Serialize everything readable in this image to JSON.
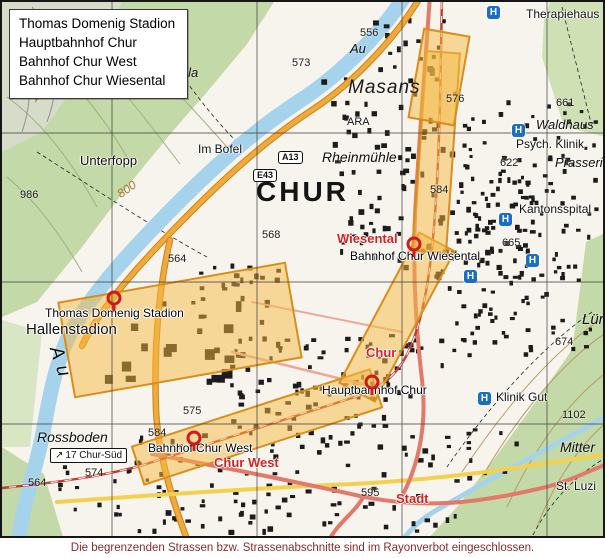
{
  "legend": {
    "items": [
      "Thomas Domenig Stadion",
      "Hauptbahnhof Chur",
      "Bahnhof Chur West",
      "Bahnhof Chur Wiesental"
    ]
  },
  "caption": "Die begrenzenden Strassen bzw. Strassenabschnitte sind im Rayonverbot eingeschlossen.",
  "colors": {
    "restriction_zone": "#f5b942",
    "station_pin": "#cf1b1b",
    "station_label_red": "#d92121",
    "caption_red": "#8a2b2b",
    "water_blue": "#a6d3ec",
    "hill_green": "#c4d9a8",
    "hospital_blue": "#1a6fc4"
  },
  "map": {
    "labels": [
      {
        "t": "CHUR",
        "x": 254,
        "y": 176,
        "c": "title"
      },
      {
        "t": "Masans",
        "x": 346,
        "y": 76,
        "c": "locality"
      },
      {
        "t": "Rheinmühle",
        "x": 320,
        "y": 148,
        "c": "place-italic",
        "fs": 14
      },
      {
        "t": "Therapiehaus",
        "x": 524,
        "y": 6,
        "c": "place"
      },
      {
        "t": "Waldhaus",
        "x": 534,
        "y": 116,
        "c": "place-italic"
      },
      {
        "t": "Psych. Klinik",
        "x": 514,
        "y": 136,
        "c": "place"
      },
      {
        "t": "Prasseri",
        "x": 553,
        "y": 154,
        "c": "place-italic"
      },
      {
        "t": "Kantonsspital",
        "x": 517,
        "y": 201,
        "c": "place"
      },
      {
        "t": "Klinik Gut",
        "x": 494,
        "y": 389,
        "c": "place"
      },
      {
        "t": "Unterfopp",
        "x": 78,
        "y": 152,
        "c": "place",
        "fs": 13
      },
      {
        "t": "Im Bofel",
        "x": 196,
        "y": 141,
        "c": "place"
      },
      {
        "t": "ARA",
        "x": 345,
        "y": 115,
        "c": "place",
        "fs": 11
      },
      {
        "t": "Au",
        "x": 348,
        "y": 40,
        "c": "place-italic"
      },
      {
        "t": "Au",
        "x": 62,
        "y": 342,
        "c": "place-italic",
        "fs": 19,
        "rot": 72,
        "ls": 7
      },
      {
        "t": "Rossboden",
        "x": 35,
        "y": 428,
        "c": "place-italic",
        "fs": 14
      },
      {
        "t": "ella",
        "x": 176,
        "y": 64,
        "c": "place-italic"
      },
      {
        "t": "Lürl",
        "x": 580,
        "y": 310,
        "c": "place-italic",
        "fs": 15
      },
      {
        "t": "Mitter",
        "x": 558,
        "y": 438,
        "c": "place-italic",
        "fs": 14
      },
      {
        "t": "St. Luzi",
        "x": 554,
        "y": 478,
        "c": "place"
      },
      {
        "t": "Hallenstadion",
        "x": 24,
        "y": 320,
        "c": "place",
        "fs": 15
      },
      {
        "t": "Thomas Domenig Stadion",
        "x": 43,
        "y": 305,
        "c": "station-black"
      },
      {
        "t": "Bahnhof Chur Wiesental",
        "x": 348,
        "y": 248,
        "c": "station-black"
      },
      {
        "t": "Hauptbahnhof Chur",
        "x": 320,
        "y": 382,
        "c": "station-black"
      },
      {
        "t": "Bahnhof Chur West",
        "x": 146,
        "y": 440,
        "c": "station-black"
      },
      {
        "t": "Wiesental",
        "x": 335,
        "y": 230,
        "c": "station-red"
      },
      {
        "t": "Chur",
        "x": 364,
        "y": 344,
        "c": "station-red"
      },
      {
        "t": "Chur West",
        "x": 212,
        "y": 454,
        "c": "station-red"
      },
      {
        "t": "Stadt",
        "x": 394,
        "y": 490,
        "c": "station-red"
      },
      {
        "t": "556",
        "x": 358,
        "y": 26,
        "c": "elev"
      },
      {
        "t": "573",
        "x": 290,
        "y": 56,
        "c": "elev"
      },
      {
        "t": "986",
        "x": 18,
        "y": 188,
        "c": "elev"
      },
      {
        "t": "568",
        "x": 260,
        "y": 228,
        "c": "elev"
      },
      {
        "t": "564",
        "x": 166,
        "y": 252,
        "c": "elev"
      },
      {
        "t": "576",
        "x": 444,
        "y": 92,
        "c": "elev"
      },
      {
        "t": "661",
        "x": 554,
        "y": 96,
        "c": "elev"
      },
      {
        "t": "622",
        "x": 498,
        "y": 156,
        "c": "elev"
      },
      {
        "t": "665",
        "x": 500,
        "y": 236,
        "c": "elev"
      },
      {
        "t": "674",
        "x": 553,
        "y": 335,
        "c": "elev"
      },
      {
        "t": "1102",
        "x": 560,
        "y": 408,
        "c": "elev"
      },
      {
        "t": "584",
        "x": 428,
        "y": 183,
        "c": "elev"
      },
      {
        "t": "584",
        "x": 146,
        "y": 426,
        "c": "elev"
      },
      {
        "t": "575",
        "x": 181,
        "y": 404,
        "c": "elev"
      },
      {
        "t": "574",
        "x": 83,
        "y": 466,
        "c": "elev"
      },
      {
        "t": "564",
        "x": 26,
        "y": 476,
        "c": "elev"
      },
      {
        "t": "595",
        "x": 359,
        "y": 486,
        "c": "elev"
      },
      {
        "t": "1200",
        "x": 25,
        "y": 95,
        "c": "contour-num",
        "rot": -55
      },
      {
        "t": "800",
        "x": 113,
        "y": 188,
        "c": "contour-num",
        "rot": -35
      }
    ],
    "pins": [
      {
        "name": "thomas-domenig-stadion",
        "x": 112,
        "y": 296
      },
      {
        "name": "bahnhof-chur-wiesental",
        "x": 412,
        "y": 242
      },
      {
        "name": "hauptbahnhof-chur",
        "x": 370,
        "y": 380
      },
      {
        "name": "bahnhof-chur-west",
        "x": 192,
        "y": 436
      }
    ],
    "hospital_icons": [
      {
        "x": 485,
        "y": 4
      },
      {
        "x": 510,
        "y": 122
      },
      {
        "x": 497,
        "y": 211
      },
      {
        "x": 462,
        "y": 268
      },
      {
        "x": 524,
        "y": 252
      },
      {
        "x": 476,
        "y": 390
      }
    ],
    "shields": [
      {
        "text": "A13",
        "x": 276,
        "y": 149
      },
      {
        "text": "E43",
        "x": 251,
        "y": 167
      }
    ],
    "exit_sign": {
      "arrow": "↗",
      "text": "17 Chur-Süd",
      "x": 48,
      "y": 446
    },
    "grid": {
      "vertical": [
        110,
        255,
        400,
        545
      ],
      "horizontal": [
        131,
        280,
        422
      ]
    }
  }
}
